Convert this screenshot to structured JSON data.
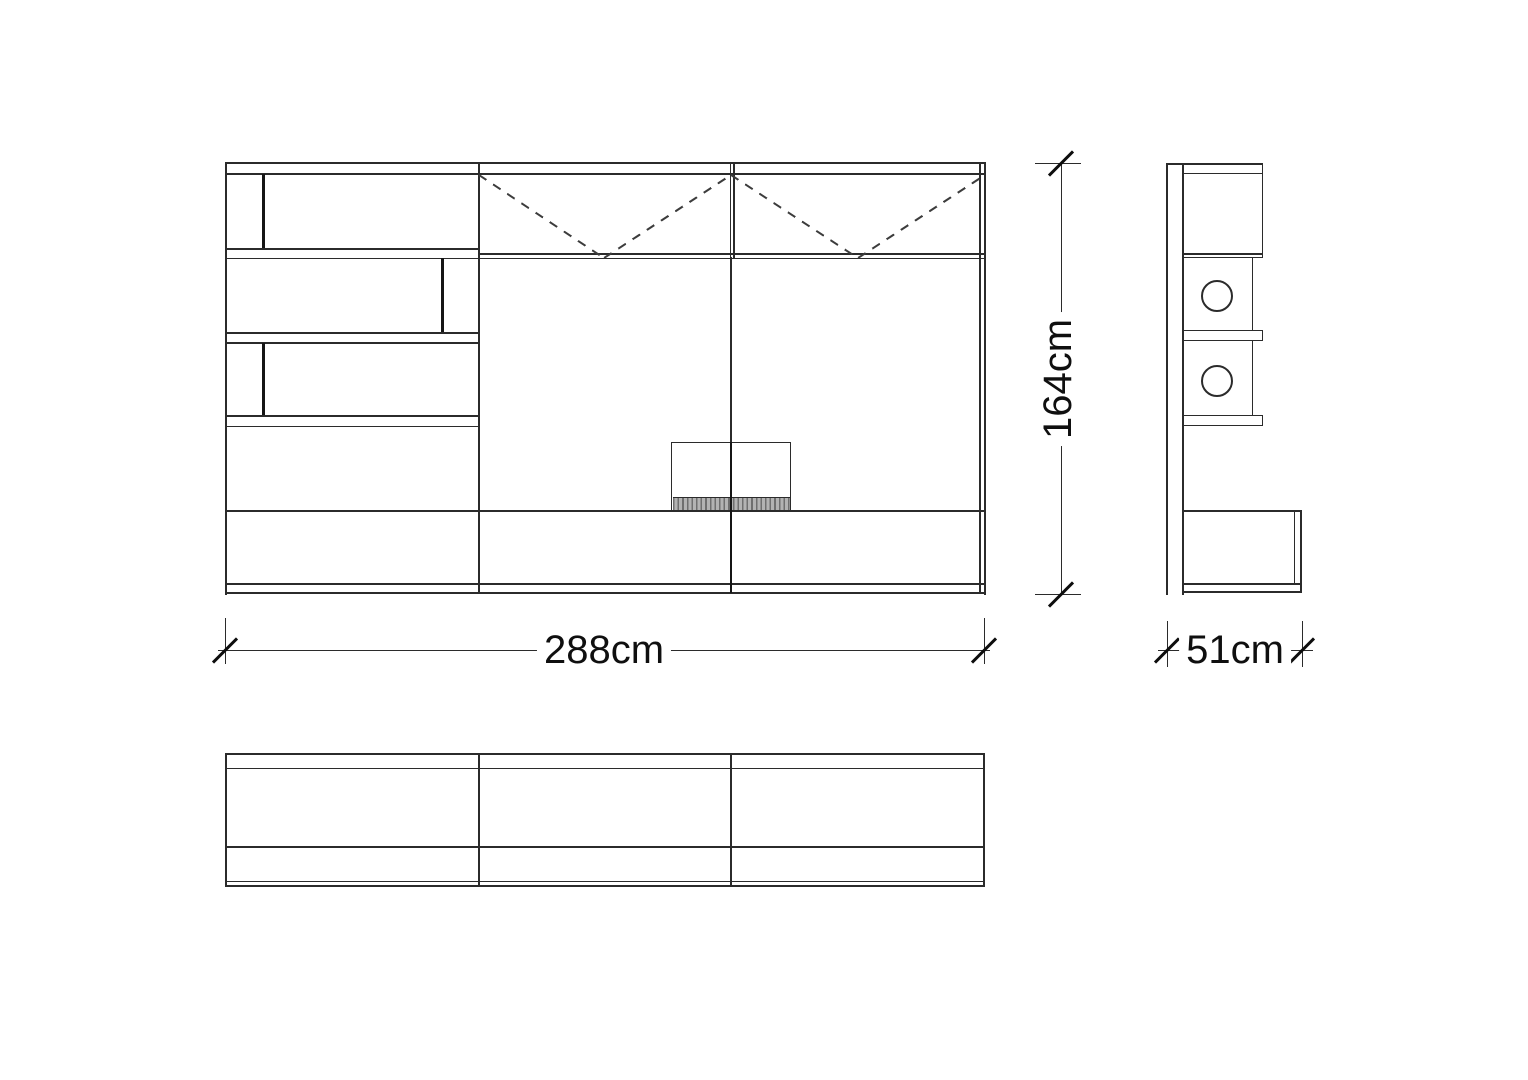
{
  "drawing": {
    "kind": "furniture-technical-drawing",
    "dimension_labels": {
      "width": "288cm",
      "height": "164cm",
      "depth": "51cm"
    }
  },
  "colors": {
    "background": "#ffffff",
    "line": "#2b2b2b",
    "line_dark": "#151515",
    "hatch_fill": "#b3b3b3",
    "hatch_stroke": "#6f6f6f"
  }
}
